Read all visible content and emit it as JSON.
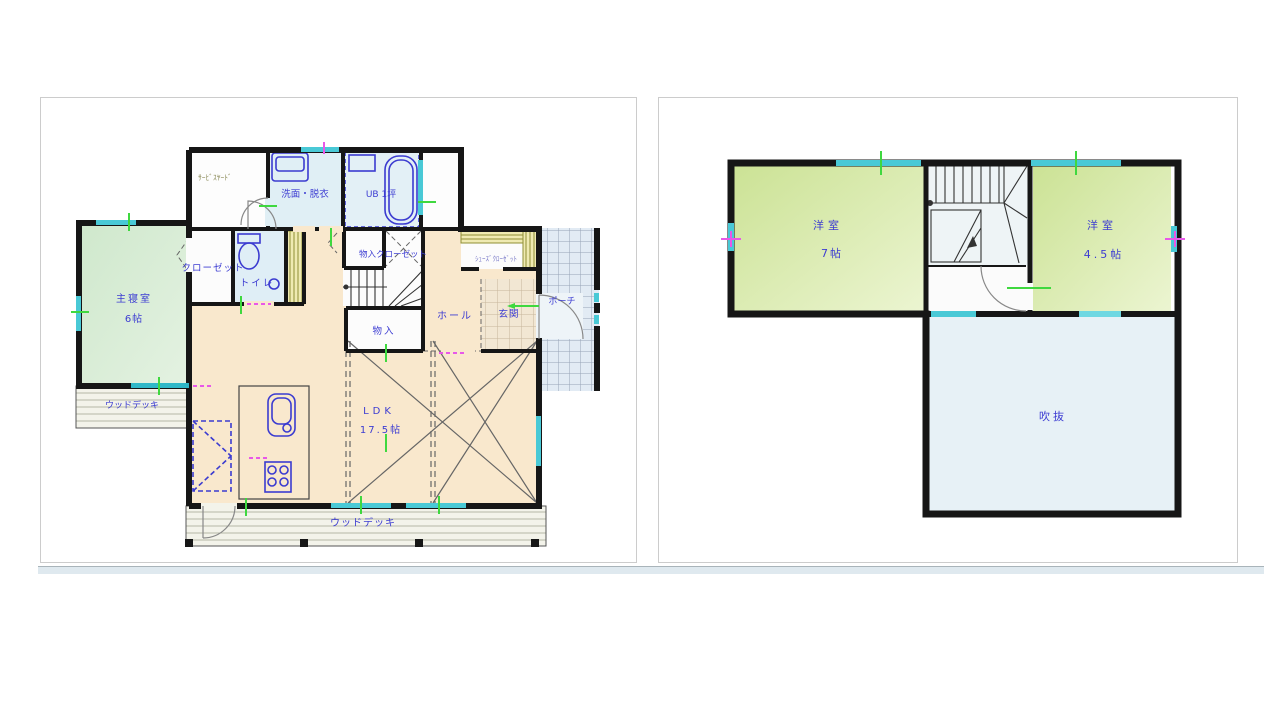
{
  "floor1": {
    "labels": {
      "service_yard": "ｻｰﾋﾞｽﾔｰﾄﾞ",
      "washroom": "洗面・脱衣",
      "bath": "UB 1坪",
      "closet": "クローゼット",
      "toilet": "トイレ",
      "master_bedroom": "主寝室",
      "master_bedroom_size": "6帖",
      "wood_deck_left": "ウッドデッキ",
      "storage_closet": "物入クローゼット",
      "shoes_closet": "ｼｭｰｽﾞｸﾛｰｾﾞｯﾄ",
      "hall": "ホール",
      "entrance": "玄関",
      "porch": "ポーチ",
      "storage": "物入",
      "ldk": "LDK",
      "ldk_size": "17.5帖",
      "wood_deck_bottom": "ウッドデッキ"
    }
  },
  "floor2": {
    "labels": {
      "room_left": "洋室",
      "room_left_size": "7帖",
      "room_right": "洋室",
      "room_right_size": "4.5帖",
      "void": "吹抜"
    }
  },
  "colors": {
    "wall": "#161616",
    "label_blue": "#3c3cd2",
    "label_olive": "#8c8c5a",
    "window_cyan": "#49c9d6",
    "tick_green": "#3fd83f",
    "tick_magenta": "#e858e8",
    "room_peach": "#f9e8cd",
    "room_green_1f": "#d9edd6",
    "room_green_2f": "#d9ecae",
    "room_wet": "#dfeef6",
    "void_blue": "#e7f1f6",
    "fixture_blue": "#3b3bd0"
  }
}
